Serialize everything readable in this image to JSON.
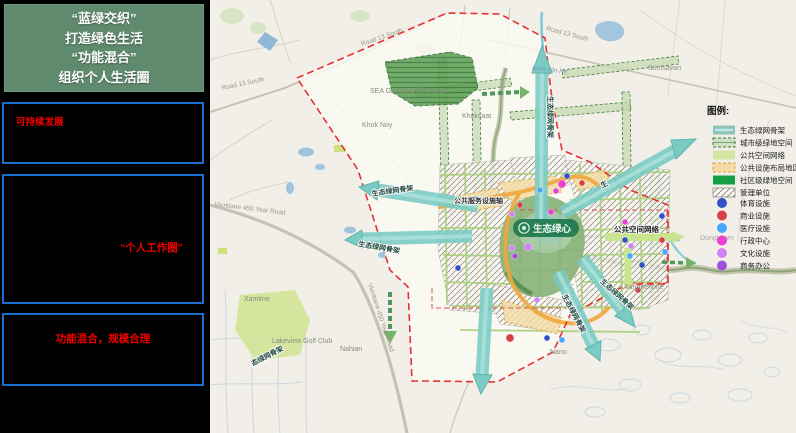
{
  "sidebar": {
    "headline": {
      "line1": "“蓝绿交织”",
      "line2": "打造绿色生活",
      "line3": "“功能混合”",
      "line4": "组织个人生活圈"
    },
    "box1": {
      "label": "可持续发展"
    },
    "box2": {
      "label": "“个人工作圈”"
    },
    "box3": {
      "label": "功能混合，规模合理"
    }
  },
  "map": {
    "center": "生态绿心",
    "axis": "公共服务设施轴",
    "corridor": "生态绿网骨架",
    "public_space_net": "公共空间网络",
    "places": {
      "road13_west": "Road 13 South",
      "road13_top": "Road 13 South",
      "road13_ne": "Road 13 South",
      "somsavan": "Somsavan",
      "nam_hin_he": "Nam Hin He",
      "khok_noy": "Khok Noy",
      "khoksaat": "Khoksaat",
      "sea_games": "SEA Games Golf Course",
      "vientiane_w": "Vientiane 450 Year Road",
      "vientiane_s": "Vientiane 450 Year Road",
      "xamkne": "Xamkne",
      "lakeview": "Lakeview Golf Club",
      "nahian": "Nahian",
      "nano": "Nano",
      "xanghenone": "Xanghenone",
      "dongkham": "Dongkham"
    },
    "facility_points": [
      {
        "x": 357,
        "y": 176,
        "type": "体育设施"
      },
      {
        "x": 352,
        "y": 184,
        "type": "行政中心",
        "r": 4
      },
      {
        "x": 346,
        "y": 191,
        "type": "行政中心"
      },
      {
        "x": 372,
        "y": 183,
        "type": "商业设施"
      },
      {
        "x": 330,
        "y": 190,
        "type": "医疗设施"
      },
      {
        "x": 341,
        "y": 212,
        "type": "行政中心"
      },
      {
        "x": 415,
        "y": 222,
        "type": "行政中心"
      },
      {
        "x": 310,
        "y": 205,
        "type": "商业设施"
      },
      {
        "x": 302,
        "y": 214,
        "type": "文化设施"
      },
      {
        "x": 265,
        "y": 199,
        "type": "体育设施"
      },
      {
        "x": 248,
        "y": 268,
        "type": "体育设施"
      },
      {
        "x": 302,
        "y": 248,
        "type": "文化设施"
      },
      {
        "x": 318,
        "y": 247,
        "type": "文化设施",
        "r": 4
      },
      {
        "x": 305,
        "y": 256,
        "type": "商务办公"
      },
      {
        "x": 415,
        "y": 240,
        "type": "体育设施"
      },
      {
        "x": 421,
        "y": 246,
        "type": "文化设施"
      },
      {
        "x": 420,
        "y": 256,
        "type": "医疗设施"
      },
      {
        "x": 432,
        "y": 265,
        "type": "体育设施"
      },
      {
        "x": 428,
        "y": 290,
        "type": "商业设施"
      },
      {
        "x": 452,
        "y": 216,
        "type": "体育设施"
      },
      {
        "x": 300,
        "y": 338,
        "type": "商业设施",
        "r": 4
      },
      {
        "x": 337,
        "y": 338,
        "type": "体育设施"
      },
      {
        "x": 352,
        "y": 340,
        "type": "医疗设施"
      },
      {
        "x": 327,
        "y": 300,
        "type": "文化设施"
      },
      {
        "x": 452,
        "y": 240,
        "type": "商业设施"
      },
      {
        "x": 455,
        "y": 252,
        "type": "医疗设施"
      }
    ]
  },
  "legend": {
    "title": "图例:",
    "area_items": [
      {
        "label": "生态绿网骨架",
        "color": "#8fc3b5"
      },
      {
        "label": "城市级绿地空间",
        "color": "#cfe0c4"
      },
      {
        "label": "公共空间网络",
        "color": "#d4e6a4"
      },
      {
        "label": "公共设施布局地区",
        "color": "#f2dda6"
      },
      {
        "label": "社区级绿地空间",
        "color": "#169e46"
      },
      {
        "label": "管理单位",
        "color": "#f8f6ee"
      }
    ],
    "point_items": [
      {
        "label": "体育设施",
        "color": "#3050c8"
      },
      {
        "label": "商业设施",
        "color": "#d84048"
      },
      {
        "label": "医疗设施",
        "color": "#45a8fc"
      },
      {
        "label": "行政中心",
        "color": "#ea3fd2"
      },
      {
        "label": "文化设施",
        "color": "#d083f2"
      },
      {
        "label": "商务办公",
        "color": "#9b52d6"
      }
    ]
  }
}
